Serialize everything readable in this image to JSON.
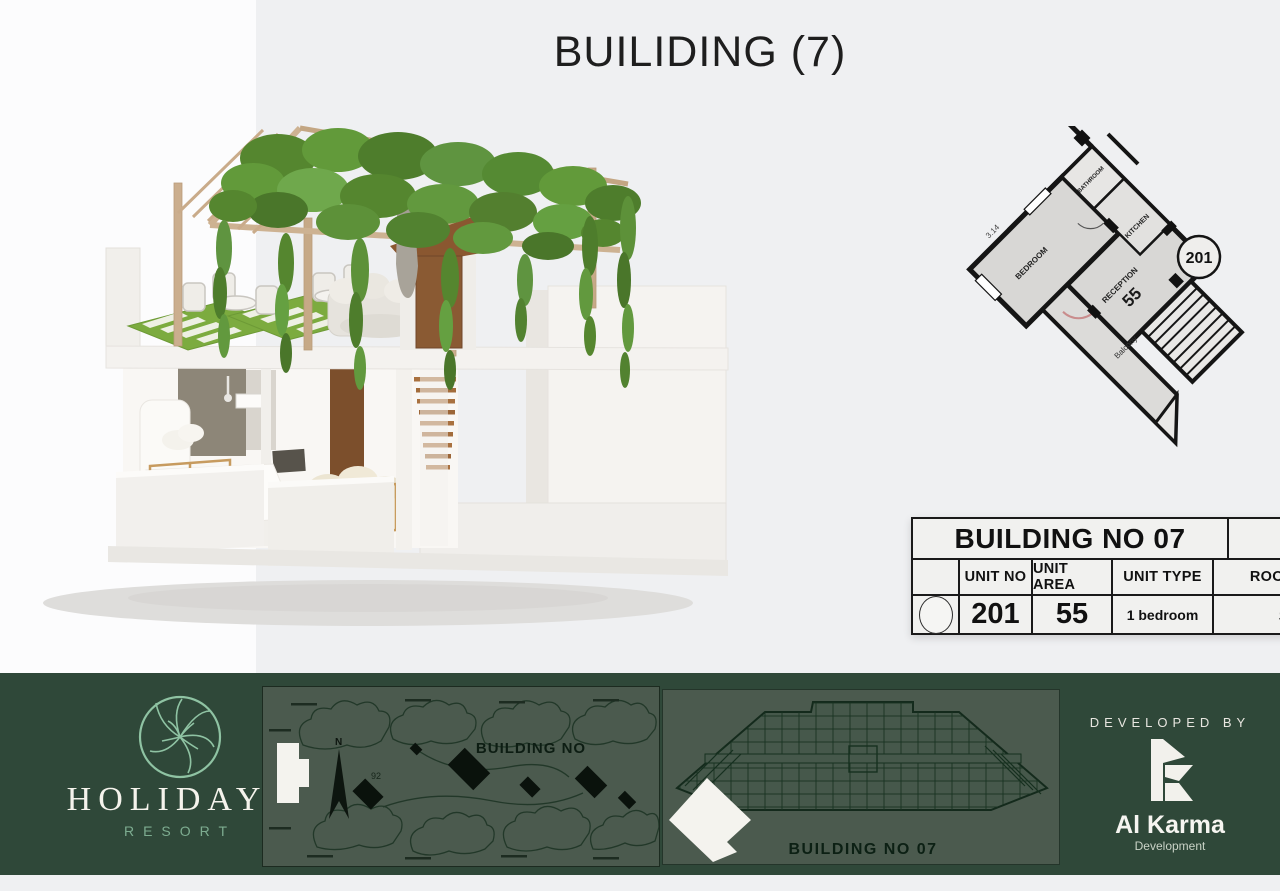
{
  "page": {
    "title": "BUILIDING (7)"
  },
  "unit_plan": {
    "unit_badge": "201",
    "rooms": {
      "bedroom": "BEDROOM",
      "bathroom": "BATHROOM",
      "kitchen": "KITCHEN",
      "reception": "RECEPTION",
      "reception_area": "55",
      "balcony": "Balcony"
    },
    "dimension": "3.14"
  },
  "unit_table": {
    "title": "BUILDING NO 07",
    "headers": {
      "unit_no": "UNIT NO",
      "unit_area": "UNIT AREA",
      "unit_type": "UNIT TYPE",
      "roof_area": "ROOF AREA"
    },
    "row": {
      "unit_no": "201",
      "unit_area": "55",
      "unit_type": "1 bedroom",
      "roof_area": "55"
    }
  },
  "footer": {
    "brand": {
      "name": "HOLIDAYS",
      "tagline": "RESORT"
    },
    "site_map": {
      "title": "BUILDING NO",
      "north_label": "N",
      "plot_label": "92"
    },
    "floor_strip": {
      "label": "BUILDING NO 07"
    },
    "developer": {
      "heading": "DEVELOPED BY",
      "name": "Al Karma",
      "subtitle": "Development"
    }
  },
  "colors": {
    "footer_green": "#2f4839",
    "panel_green": "#4b5a4e",
    "logo_green": "#8fc3a3",
    "pergola_wood": "#cbae8e",
    "foliage_green": "#5f9440",
    "table_ink": "#111111"
  }
}
